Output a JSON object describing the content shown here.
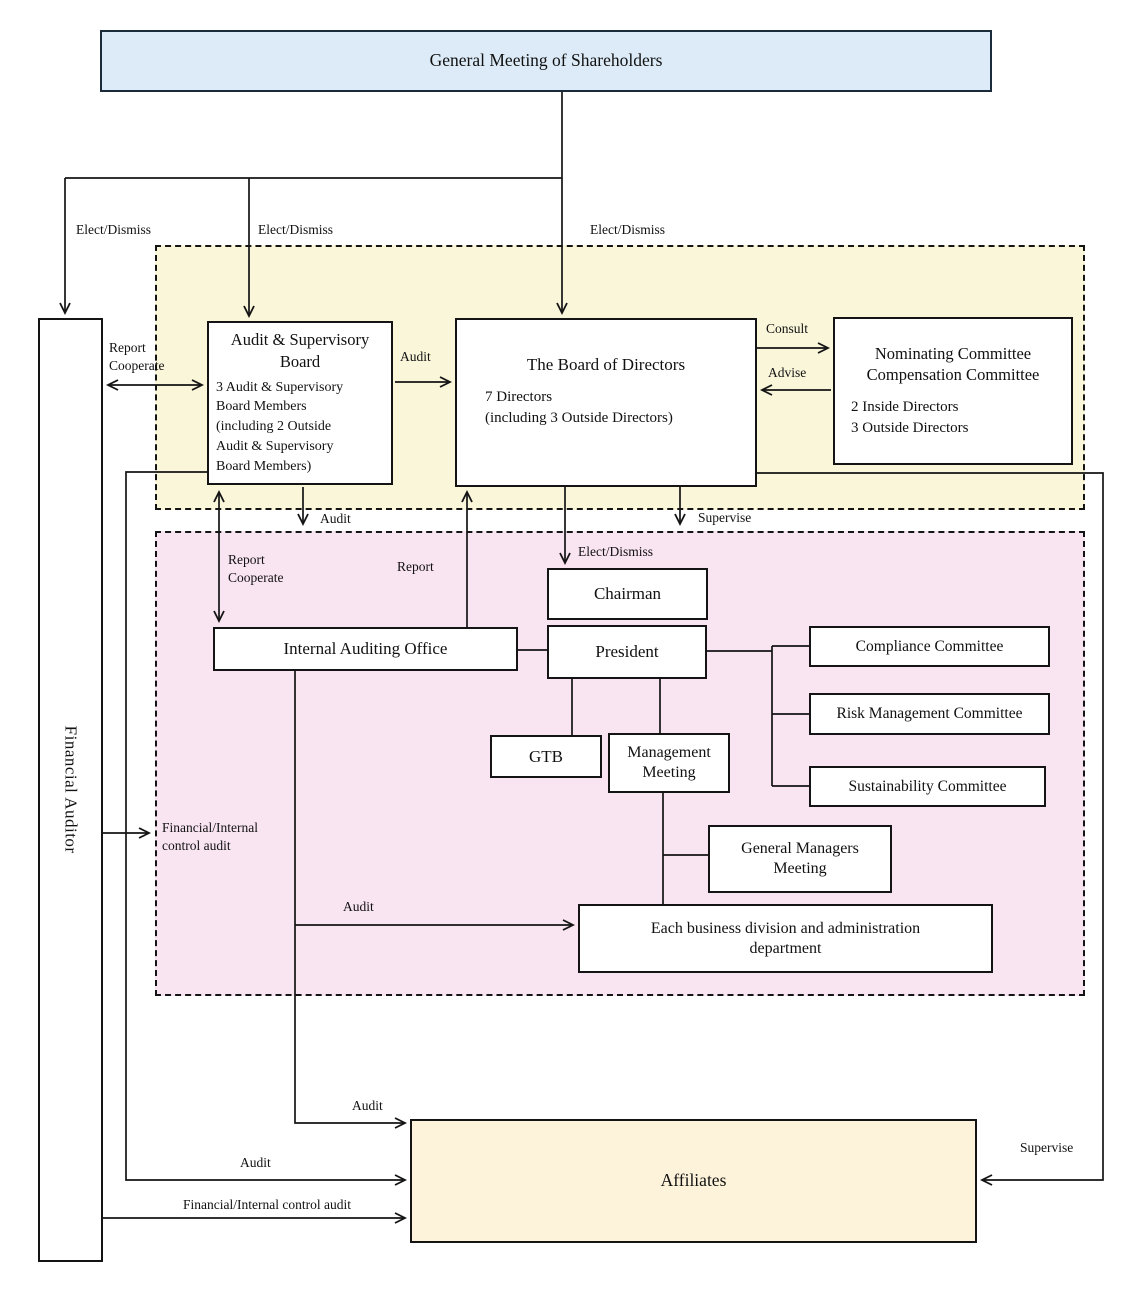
{
  "nodes": {
    "gms": {
      "label": "General Meeting of Shareholders"
    },
    "financial_auditor": {
      "label": "Financial Auditor"
    },
    "asb": {
      "title": "Audit & Supervisory Board",
      "body": "3 Audit & Supervisory\nBoard Members\n(including 2 Outside\nAudit & Supervisory\nBoard Members)"
    },
    "bod": {
      "title": "The Board of Directors",
      "body": "7 Directors\n(including 3 Outside Directors)"
    },
    "nomcomp": {
      "title": "Nominating Committee\nCompensation Committee",
      "body": "2 Inside Directors\n3 Outside Directors"
    },
    "chairman": {
      "label": "Chairman"
    },
    "president": {
      "label": "President"
    },
    "iao": {
      "label": "Internal Auditing Office"
    },
    "gtb": {
      "label": "GTB"
    },
    "mgmt_meeting": {
      "label": "Management\nMeeting"
    },
    "compliance": {
      "label": "Compliance Committee"
    },
    "risk": {
      "label": "Risk Management Committee"
    },
    "sustainability": {
      "label": "Sustainability Committee"
    },
    "gmm": {
      "label": "General Managers\nMeeting"
    },
    "ebd": {
      "label": "Each business division and administration\ndepartment"
    },
    "affiliates": {
      "label": "Affiliates"
    }
  },
  "edge_labels": {
    "elect_dismiss_fa": "Elect/Dismiss",
    "elect_dismiss_asb": "Elect/Dismiss",
    "elect_dismiss_bod": "Elect/Dismiss",
    "report_cooperate_fa": "Report\nCooperate",
    "audit_asb_bod": "Audit",
    "consult": "Consult",
    "advise": "Advise",
    "audit_asb_down": "Audit",
    "supervise_bod_down": "Supervise",
    "report_cooperate_iao": "Report\nCooperate",
    "report_iao_bod": "Report",
    "elect_dismiss_chairman": "Elect/Dismiss",
    "fin_internal_audit": "Financial/Internal\ncontrol audit",
    "audit_iao_ebd": "Audit",
    "audit_iao_affiliates": "Audit",
    "audit_asb_affiliates": "Audit",
    "fin_internal_audit_affiliates": "Financial/Internal control audit",
    "supervise_affiliates": "Supervise"
  },
  "colors": {
    "region_board": "#faf6da",
    "region_exec": "#f9e4f1",
    "gms_fill": "#dcebf7",
    "affiliates_fill": "#fdf3da",
    "line": "#141414"
  }
}
